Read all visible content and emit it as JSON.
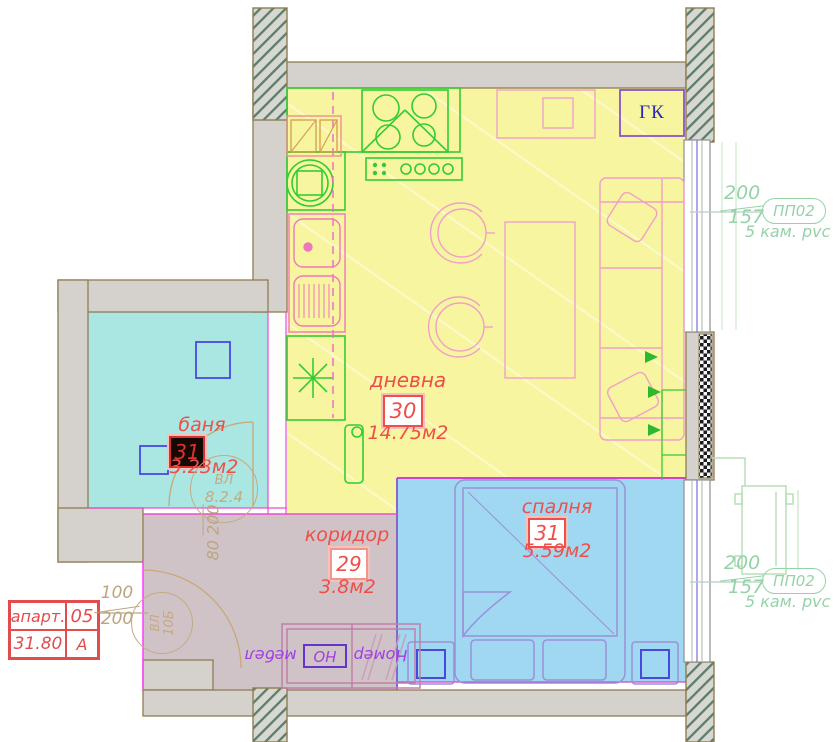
{
  "rooms": {
    "living": {
      "name": "дневна",
      "number": "30",
      "area": "14.75м2"
    },
    "bath": {
      "name": "баня",
      "number": "31",
      "area": "3.23м2"
    },
    "corridor": {
      "name": "коридор",
      "number": "29",
      "area": "3.8м2"
    },
    "bedroom": {
      "name": "спалня",
      "number": "31",
      "area": "5.59м2"
    }
  },
  "closet": {
    "label": "ГК"
  },
  "windows": {
    "living": {
      "width": "200",
      "height": "157",
      "tag": "ПП02",
      "spec": "5 кам. pvc"
    },
    "bedroom": {
      "width": "200",
      "height": "157",
      "tag": "ПП02",
      "spec": "5 кам. pvc"
    }
  },
  "doors": {
    "entrance_dim": {
      "w": "100",
      "h": "200"
    },
    "bath_dim": {
      "w": "80",
      "h": "200"
    },
    "bath_tag": {
      "line1": "ВЛ",
      "line2": "8.2.4"
    },
    "entrance_tag": {
      "line1": "ВЛ",
      "line2": "10Б"
    }
  },
  "stamp": {
    "label": "апарт.",
    "number": "05",
    "total_area": "31.80",
    "letter": "A"
  },
  "furniture_note": {
    "prefix": "Номер",
    "code": "НО",
    "suffix": "мебел"
  },
  "colors": {
    "living": "#f8f5a0",
    "bath": "#aae6e2",
    "bedroom": "#a0d8f2",
    "corridor": "#d0c3c7",
    "wall": "#d5d2ce",
    "label_red": "#ee4f4b",
    "annotation_green": "#96d2a8",
    "dim_tan": "#bba581",
    "furniture_pink": "#f0a0c8",
    "kitchen_green": "#33cc33",
    "bed_purple": "#9a90d8",
    "partition_magenta": "#e84fd0"
  }
}
